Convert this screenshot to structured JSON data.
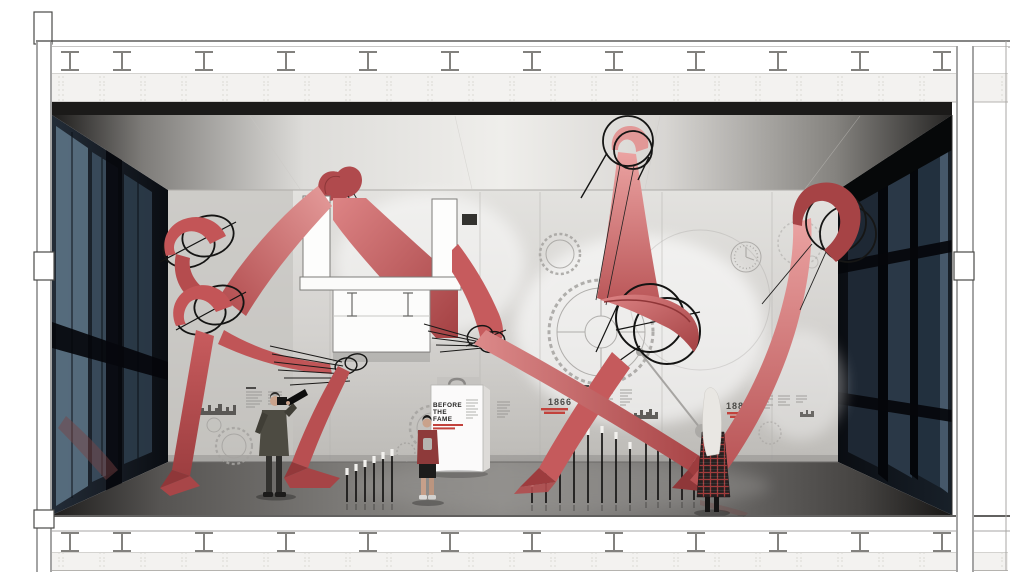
{
  "exhibit": {
    "bag_panel": {
      "title_lines": [
        "BEFORE",
        "THE",
        "FAME"
      ]
    },
    "timeline": [
      {
        "year": "1866"
      },
      {
        "year": "1880"
      }
    ]
  },
  "palette": {
    "ribbon_red": "#cf6163",
    "ribbon_light": "#eba6a5",
    "ribbon_dark": "#a64244",
    "accent_red_text": "#c2423c",
    "glass_reflection_blue": "#3c4e5e",
    "wall_gray": "#d6d4d1",
    "floor_gray": "#7b7976",
    "structure_line": "#4a4a48"
  }
}
